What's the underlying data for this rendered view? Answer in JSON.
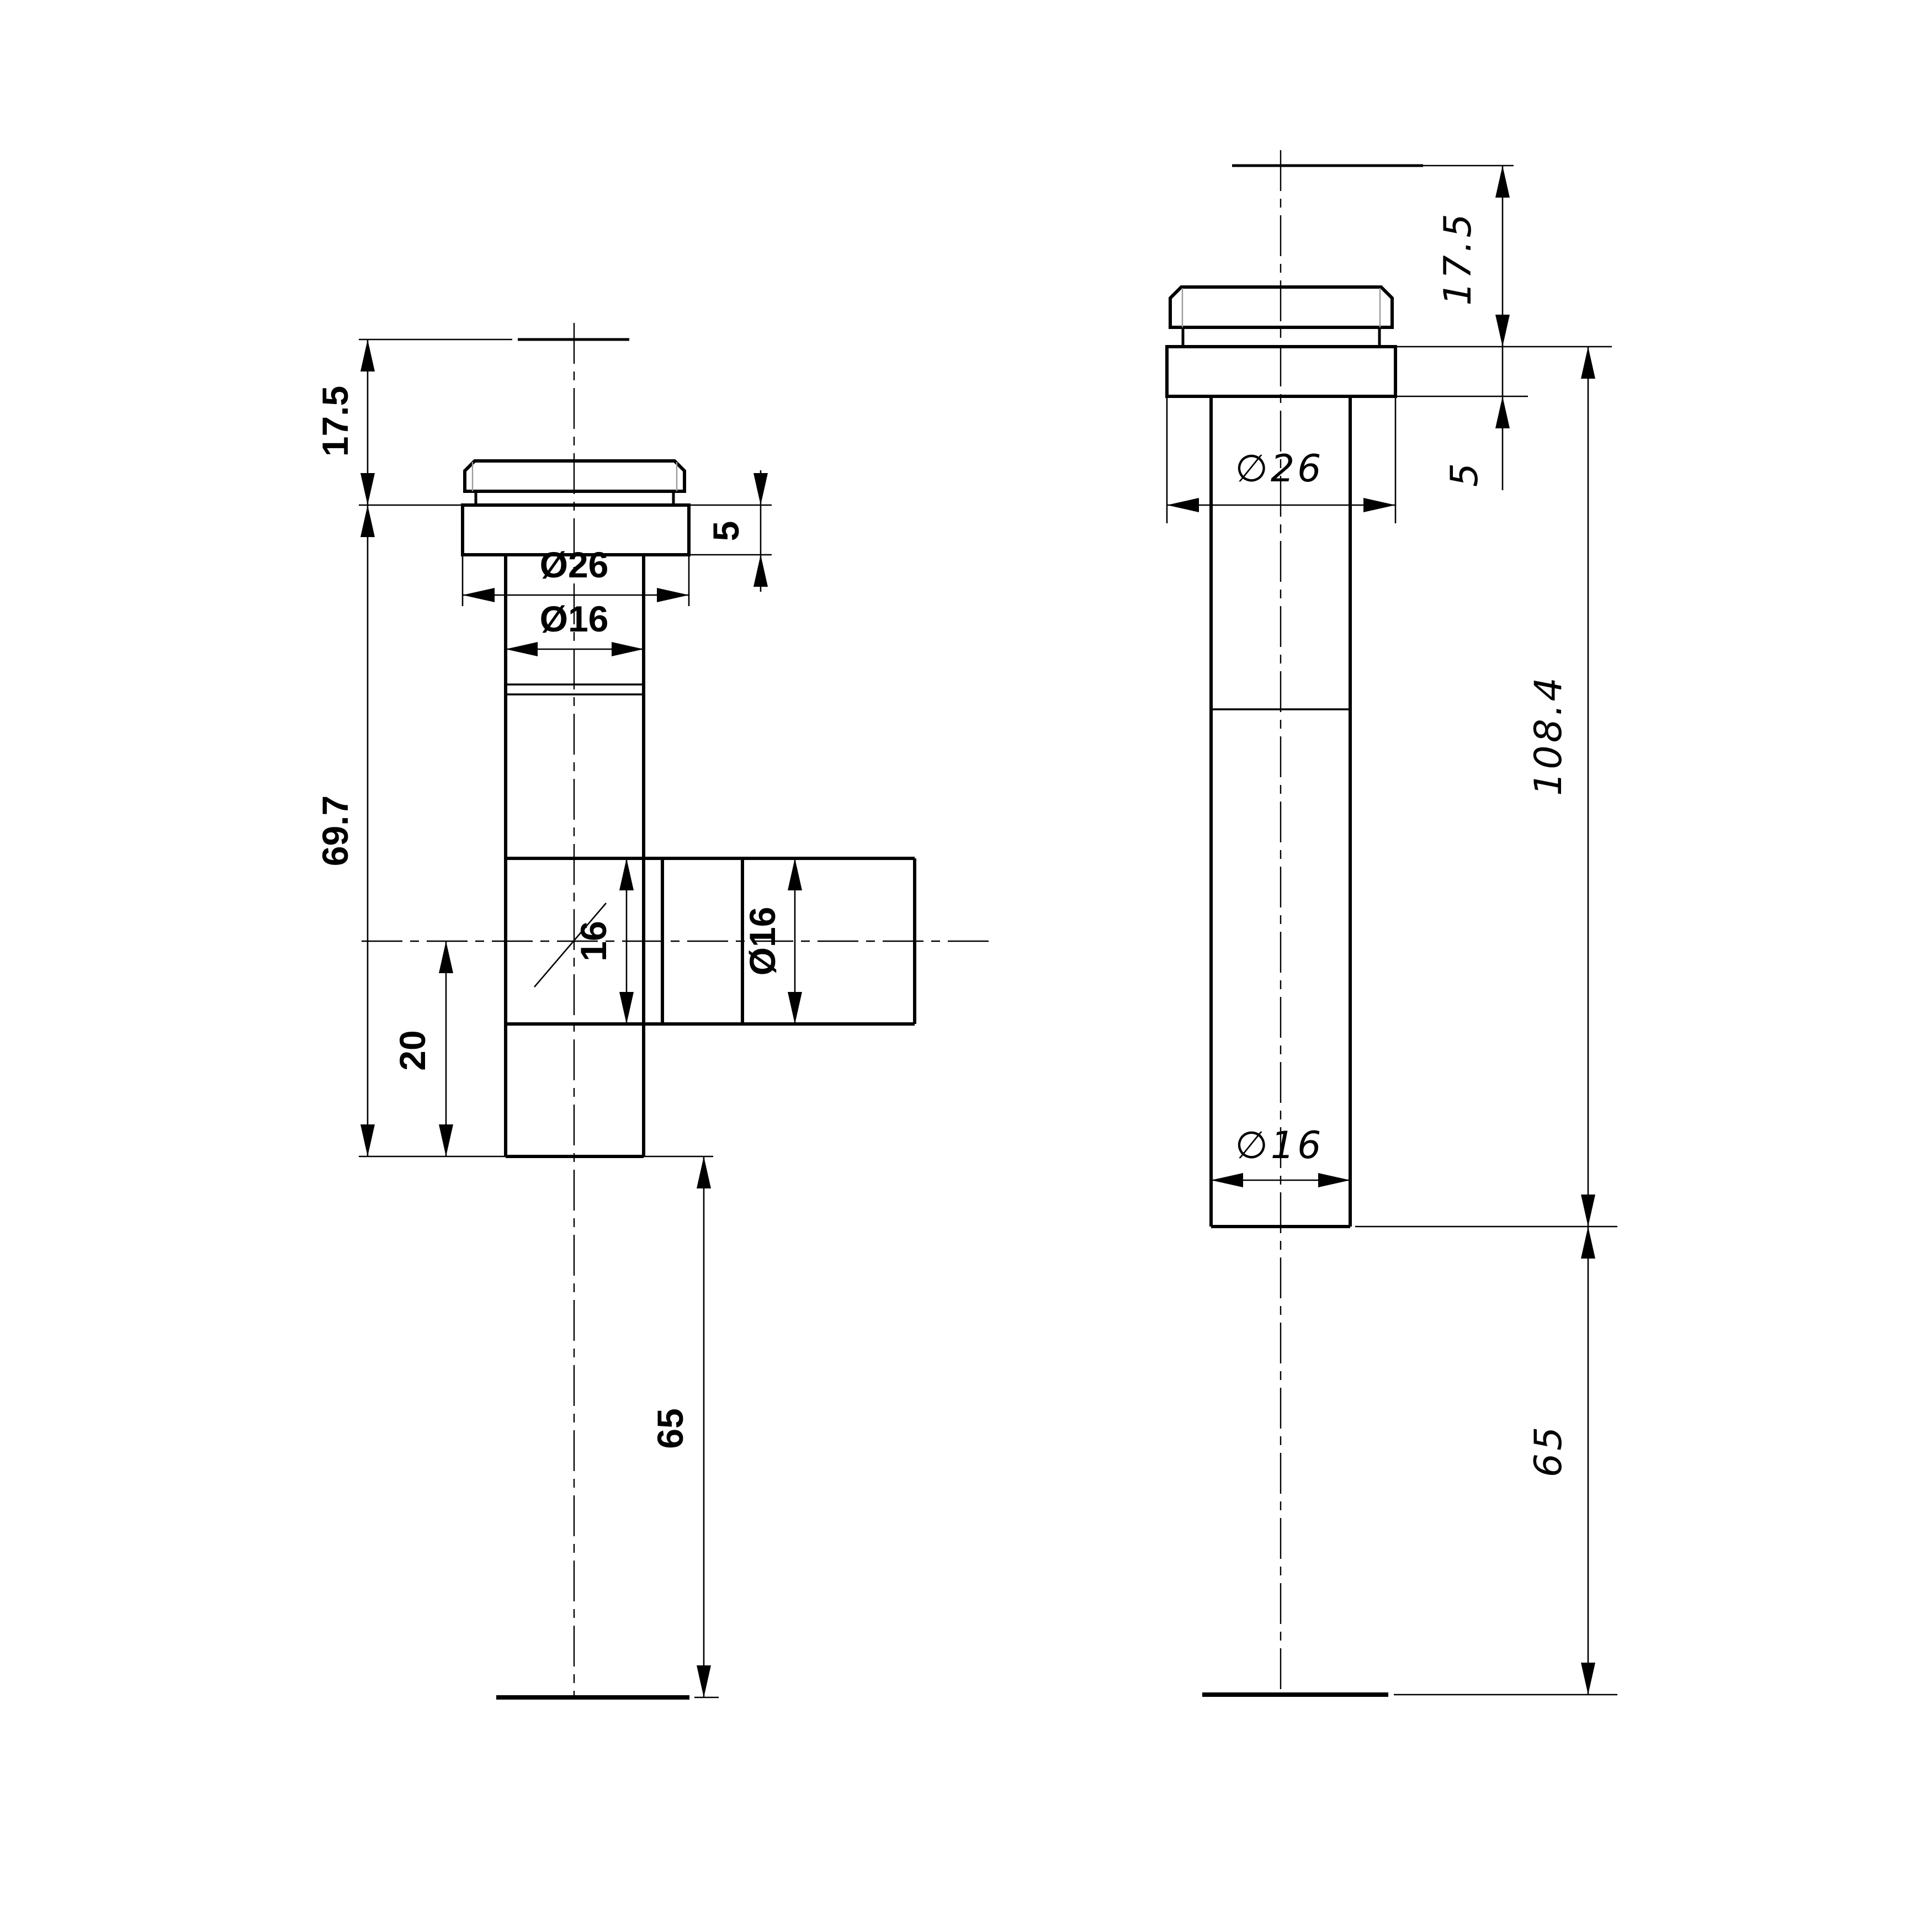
{
  "drawing": {
    "type": "technical-two-view-dimensioned-drawing",
    "background_color": "#ffffff",
    "line_color": "#000000",
    "chamfer_line_color": "#9a9a9a",
    "views": {
      "front": {
        "title": "front-view-with-side-branch",
        "dims": {
          "h17_5": "17.5",
          "h69_7": "69.7",
          "d26": "Ø26",
          "d16_shaft": "Ø16",
          "f5": "5",
          "b16": "16",
          "d16_branch": "Ø16",
          "o20": "20",
          "d65": "65"
        }
      },
      "side": {
        "title": "side-view",
        "dims": {
          "h17_5": "17.5",
          "d26": "∅26",
          "f5": "5",
          "h108_4": "108.4",
          "d16": "∅16",
          "d65": "65"
        }
      }
    }
  }
}
